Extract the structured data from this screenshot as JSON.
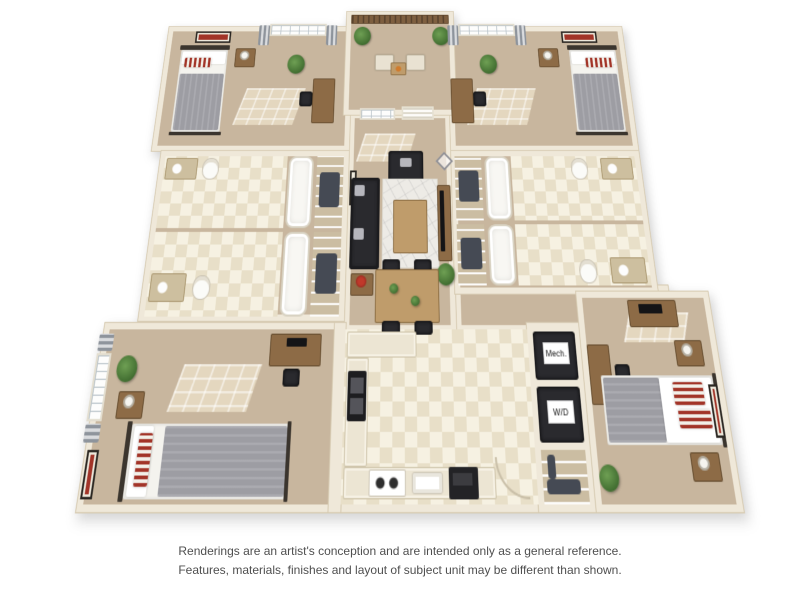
{
  "image": {
    "width": 800,
    "height": 600,
    "background": "#ffffff",
    "subject": "3D rendered floor plan of a four-bedroom, four-bathroom apartment with balcony, central living room and kitchen"
  },
  "labels": {
    "mech": "Mech.",
    "wd": "W/D"
  },
  "disclaimer": {
    "line1": "Renderings are an artist's conception and are intended only as a general reference.",
    "line2": "Features, materials, finishes and layout of subject unit may be different than shown."
  },
  "colors": {
    "wall": "#efe8d9",
    "wall_edge": "#d6cab1",
    "carpet": "#c8b69e",
    "tile_light": "#f6f1e2",
    "tile_dark": "#e8dfc8",
    "sofa_black": "#2a2a2e",
    "duvet_gray": "#9d9da3",
    "wood": "#8d6b46",
    "wood_light": "#bf9c6b",
    "accent_red": "#a23428",
    "plant_green": "#4e7d3a",
    "counter": "#ece5d3",
    "railing": "#7e5f40",
    "disclaimer_text": "#4f4f4f"
  }
}
